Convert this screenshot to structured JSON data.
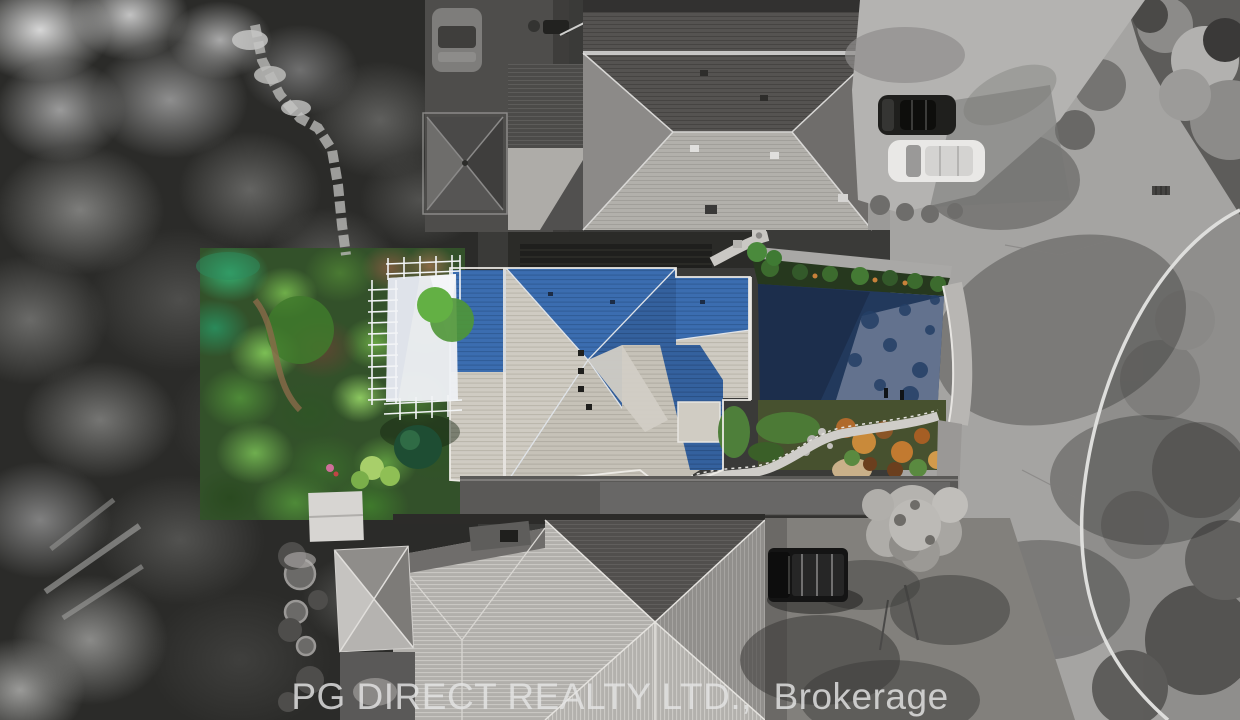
{
  "watermark": {
    "text": "PG DIRECT REALTY LTD.,  Brokerage"
  },
  "scene": {
    "type": "aerial-drone-photo",
    "style": "subject lot shown in color; all surrounding properties desaturated to grayscale",
    "subject_property": {
      "label": "color-highlighted subject property",
      "features": [
        "complex hip roof with blue shaded faces and light sunlit faces",
        "white shade-sail pergola with trellis frame",
        "lush green landscaped garden beds",
        "dark asphalt driveway with hedge",
        "winding stone path with railing",
        "autumn-orange rock garden"
      ],
      "colors": {
        "roof_shaded": "#3a6cae",
        "roof_sunlit": "#cdc9c0",
        "driveway": "#22395c",
        "garden": "#4e8a38",
        "shade_sail": "#eef1f5",
        "autumn_planting": "#b06a2c"
      }
    },
    "surroundings": {
      "north_neighbor": "large gray hip-roof house with gazebo, courtyard and parked car",
      "northeast": "concrete driveway with dark sedan and white SUV",
      "east": "curved suburban road with white curb, lawn and mature trees",
      "south_neighbor": "metal hip-roof house with black pickup truck, shed and backyard gazebo",
      "west": "dense mature tree canopy"
    }
  }
}
